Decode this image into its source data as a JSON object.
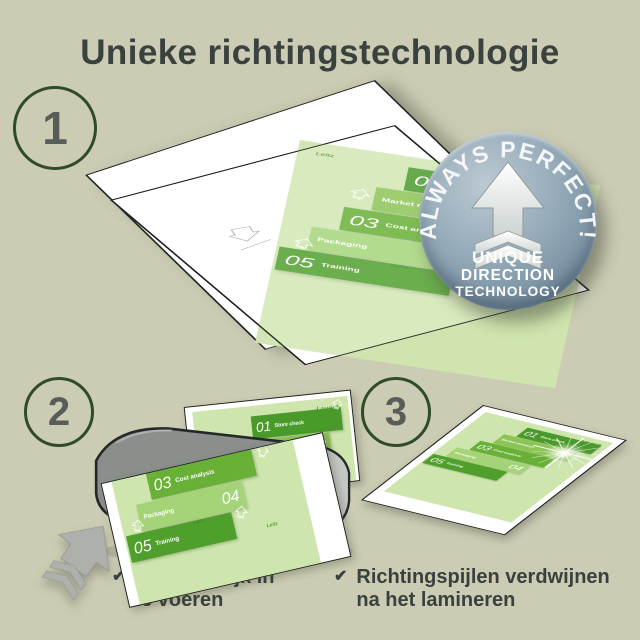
{
  "title": "Unieke richtingstechnologie",
  "steps": {
    "one": "1",
    "two": "2",
    "three": "3"
  },
  "badge": {
    "arc_text": "ALWAYS PERFECT!",
    "line1": "UNIQUE",
    "line2": "DIRECTION",
    "line3": "TECHNOLOGY"
  },
  "document": {
    "launch": "Launch",
    "watermark": "Leitz",
    "sections": [
      {
        "num": "01",
        "label": "Store check",
        "color": "#4a9a2b",
        "num_side": "left"
      },
      {
        "num": "02",
        "label": "Market research",
        "color": "#8cc455",
        "num_side": "right"
      },
      {
        "num": "03",
        "label": "Cost analysis",
        "color": "#68b036",
        "num_side": "left"
      },
      {
        "num": "04",
        "label": "Packaging",
        "color": "#a5d478",
        "num_side": "right"
      },
      {
        "num": "05",
        "label": "Training",
        "color": "#4f9f2c",
        "num_side": "left"
      }
    ]
  },
  "captions": {
    "first": {
      "check": "✔",
      "line1": "Gemakkelijk in",
      "line2": "te voeren"
    },
    "second": {
      "check": "✔",
      "line1": "Richtingspijlen verdwijnen",
      "line2": "na het lamineren"
    }
  },
  "colors": {
    "background": "#cbccb3",
    "text": "#3a423f",
    "accent_green": "#4a9a2b",
    "document_base": "#cfe5ae",
    "badge_blue": "#8ba1b1",
    "machine_gray": "#8b8f8c",
    "circle_border_green": "#2e4c25"
  }
}
